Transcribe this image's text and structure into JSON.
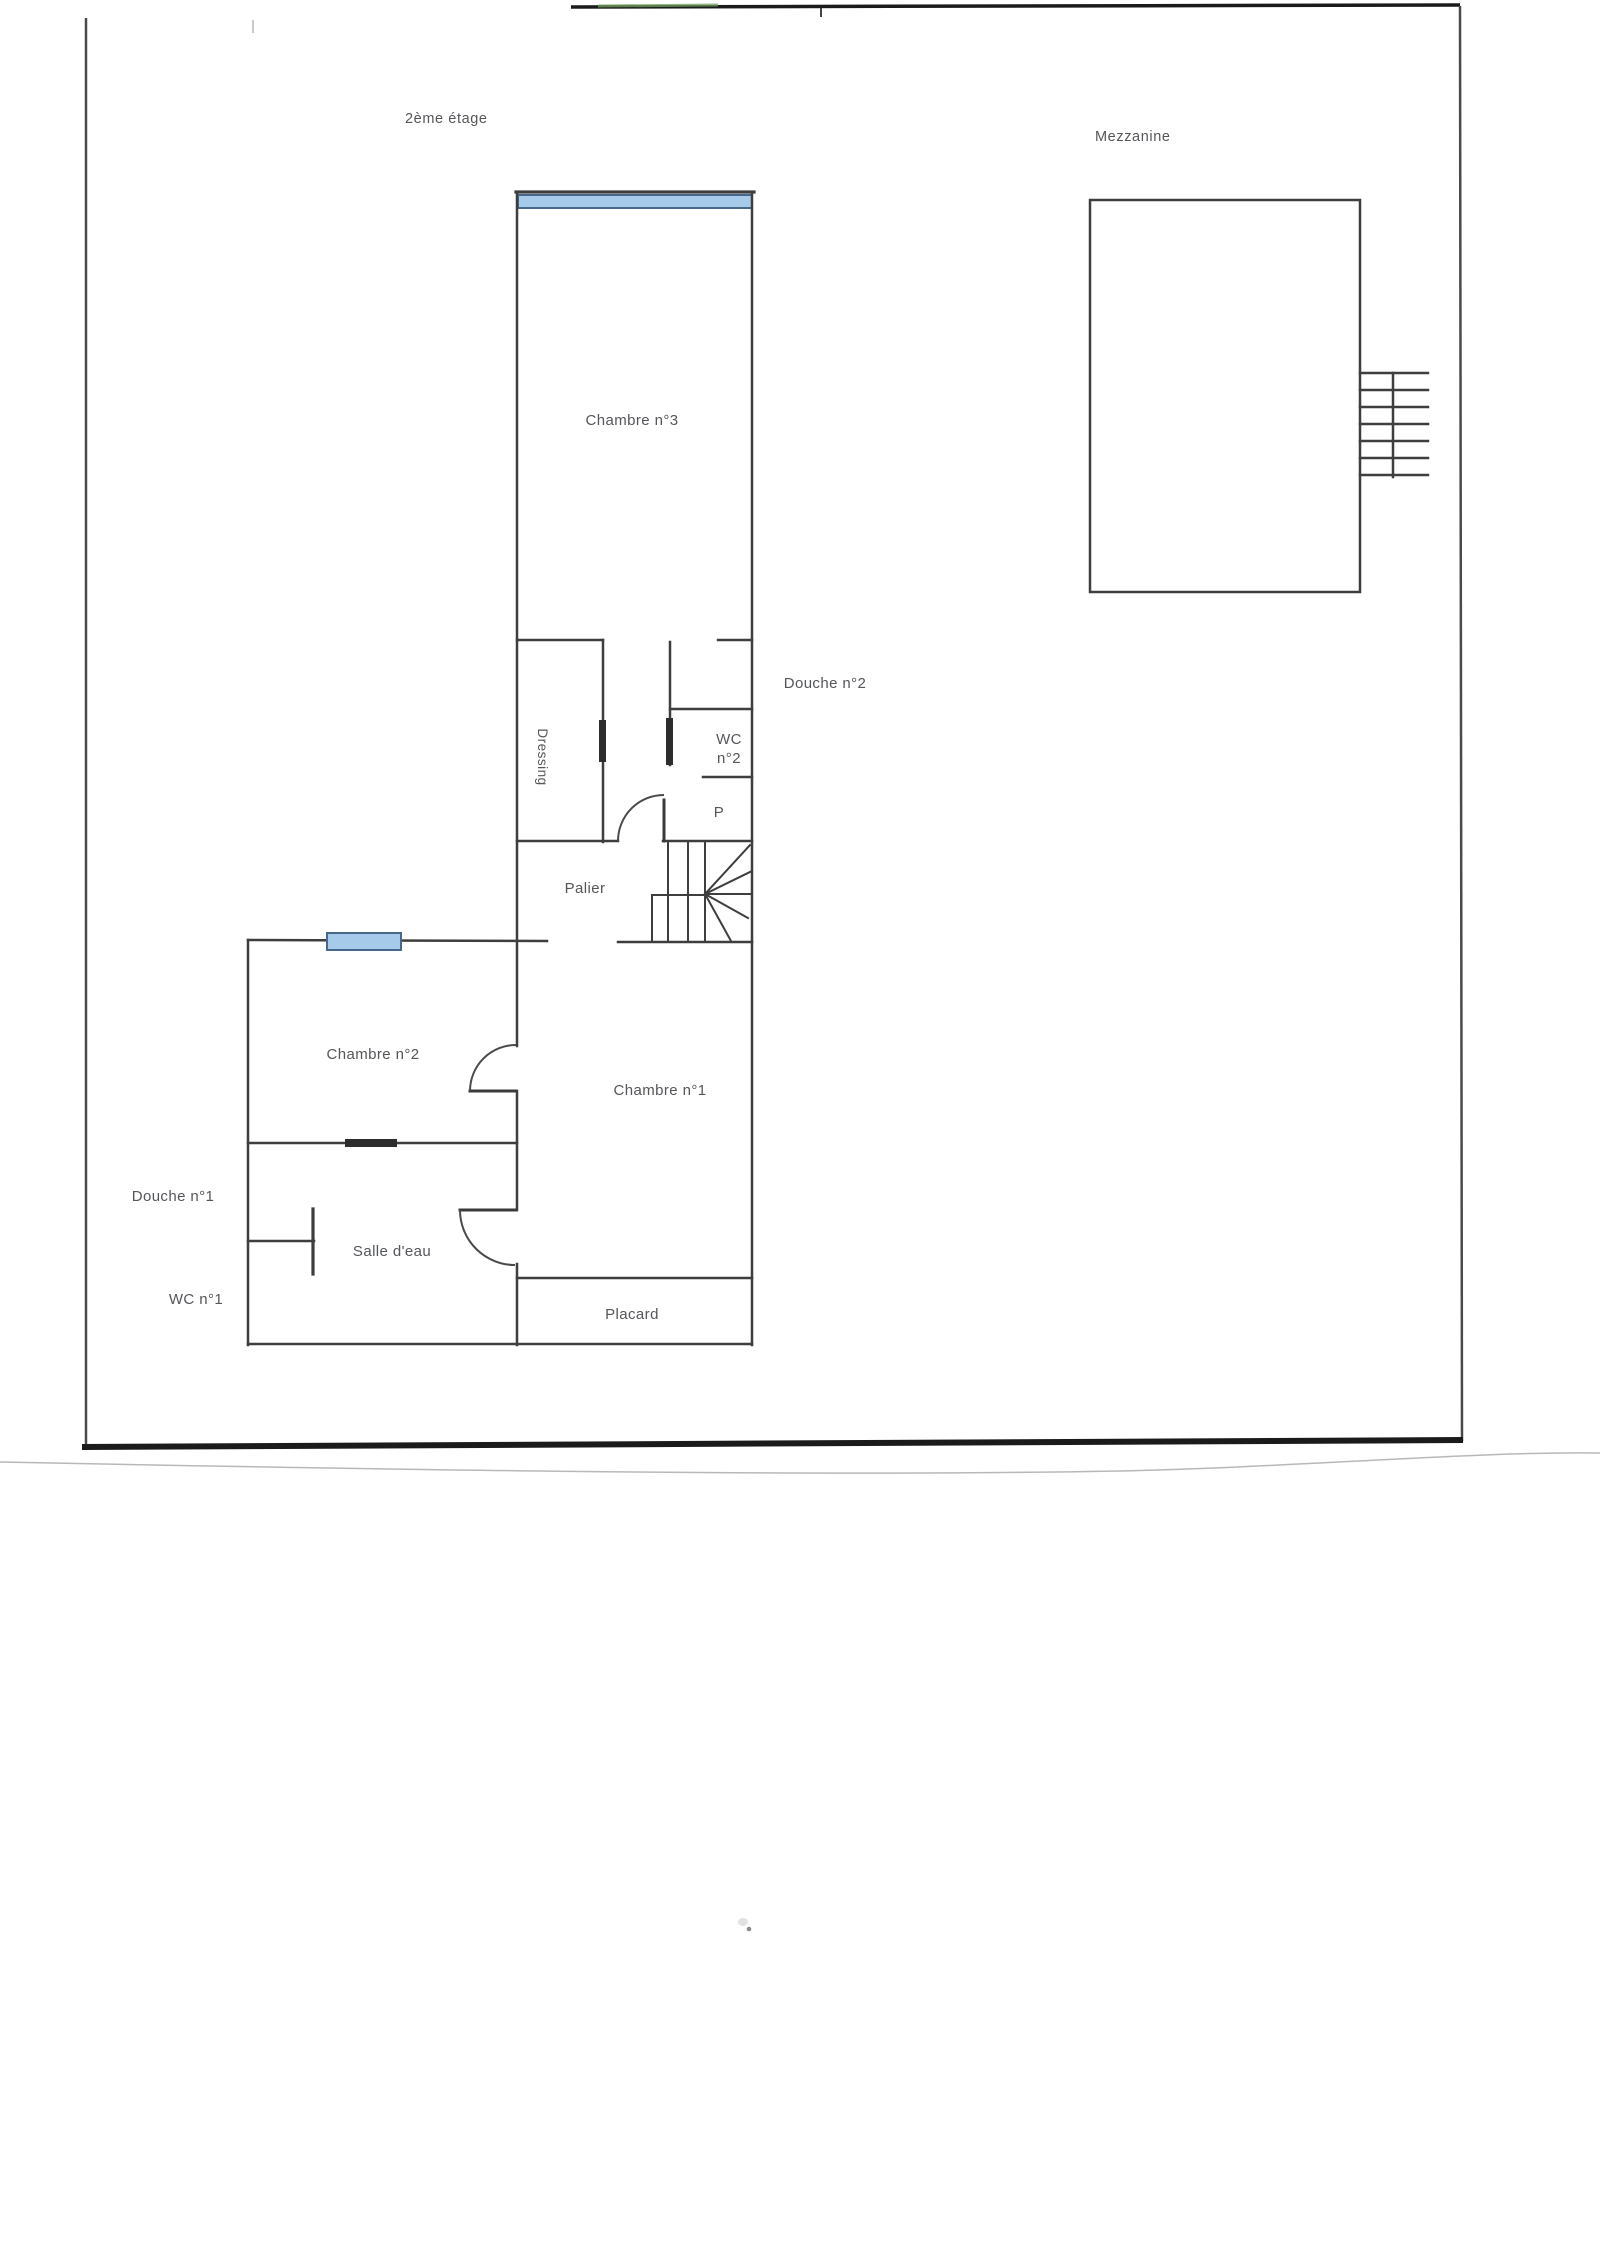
{
  "document": {
    "type": "scanned floor plan",
    "floor_title": "2ème étage",
    "mezzanine_title": "Mezzanine"
  },
  "labels": {
    "floor": "2ème étage",
    "mezzanine": "Mezzanine",
    "chambre3": "Chambre n°3",
    "douche2": "Douche n°2",
    "dressing": "Dressing",
    "wc2_line1": "WC",
    "wc2_line2": "n°2",
    "placard_small": "P",
    "palier": "Palier",
    "chambre2": "Chambre n°2",
    "chambre1": "Chambre n°1",
    "douche1": "Douche n°1",
    "salle_deau": "Salle d'eau",
    "wc1": "WC n°1",
    "placard": "Placard"
  },
  "colors": {
    "wall": "#3e3e3e",
    "window_fill": "#a6cbea",
    "window_border": "#47688c",
    "label_text": "#55565a",
    "door_panel": "#2d2d2d",
    "page_edge_dark": "#1b1b1b"
  }
}
